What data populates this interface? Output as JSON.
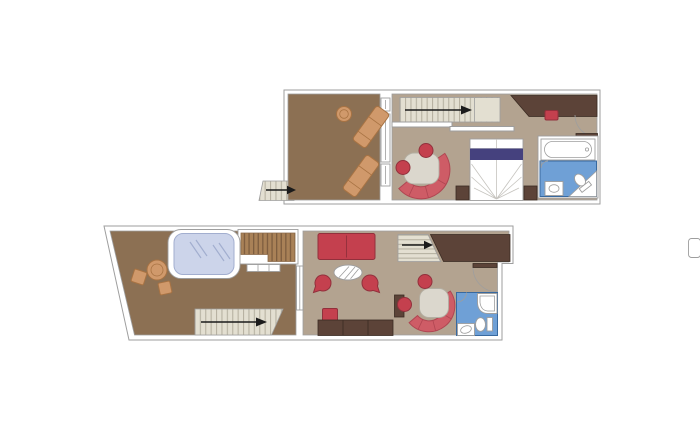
{
  "canvas": {
    "width": 700,
    "height": 433,
    "background_color": "#ffffff"
  },
  "colors": {
    "wall-line": "#9e9e9e",
    "floor-outdoor": "#8c7053",
    "floor-indoor": "#b3a390",
    "stair": "#e3dfd1",
    "stair-line": "#b7b2a2",
    "deck": "#a98157",
    "deck-line": "#7d5d3f",
    "red": "#c4404e",
    "red-dark": "#92303c",
    "bench": "#ce5c66",
    "bench-dark": "#b04652",
    "orange": "#d0996b",
    "orange-dark": "#a87343",
    "navy": "#45417e",
    "wood": "#5c4338",
    "wood-line": "#3a2b22",
    "bath-blue": "#6fa0d6",
    "bath-blue-line": "#38699f",
    "glass": "#ccd4ea",
    "glass-line": "#a2aecf",
    "table-grey": "#dbd7cd",
    "arrow": "#1b1b1b"
  },
  "plans": [
    {
      "name": "upper-level-plan",
      "rooms": [
        "balcony",
        "bedroom",
        "bathroom",
        "staircase"
      ],
      "furniture": [
        "sun-lounger",
        "sun-lounger",
        "round-table",
        "staircase-with-direction-arrow",
        "balcony-entry-arrow",
        "curved-sofa-with-table",
        "two-round-chairs",
        "double-bed",
        "nightstand",
        "nightstand",
        "wardrobe",
        "red-bench",
        "bathtub",
        "toilet",
        "washbasin",
        "entrance-door"
      ]
    },
    {
      "name": "lower-level-plan",
      "rooms": [
        "terrace",
        "living-room",
        "bathroom",
        "staircase"
      ],
      "furniture": [
        "whirlpool-bath",
        "wood-deck",
        "glass-rail",
        "outdoor-round-table",
        "outdoor-chair",
        "outdoor-chair",
        "terrace-staircase-with-arrow",
        "sofa",
        "coffee-table",
        "armchair",
        "armchair",
        "pouf",
        "sideboard",
        "cabinet",
        "interior-staircase-with-arrow",
        "wardrobe",
        "curved-sofa-with-table",
        "two-round-chairs",
        "shower",
        "toilet",
        "washbasin",
        "entrance-door"
      ]
    }
  ]
}
